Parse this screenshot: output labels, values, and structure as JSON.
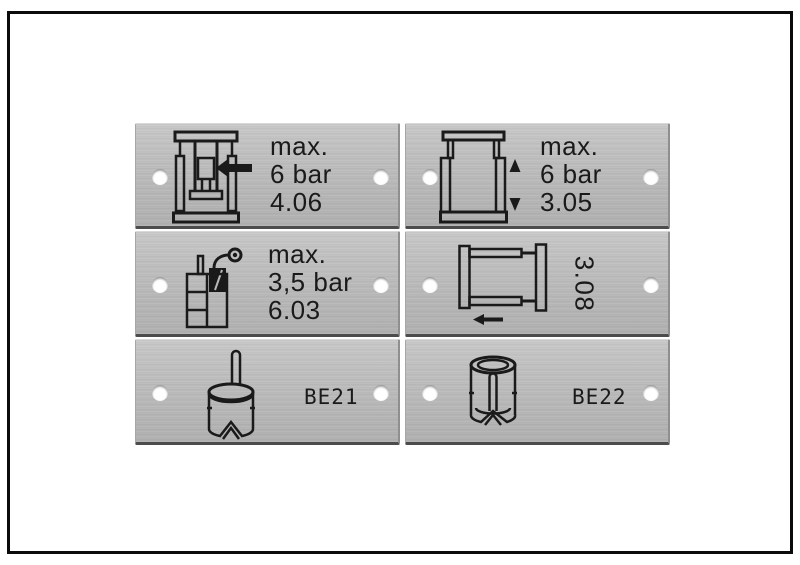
{
  "image": {
    "kind": "product photo of six engraved aluminum machine labels",
    "frame_color": "#0b0b0b",
    "background": "#ffffff",
    "metal_color": "#b8b8b8",
    "ink_color": "#1a1a1a"
  },
  "plates": [
    {
      "name": "toggle-press-label",
      "icon": "toggle-press-icon",
      "lines": [
        "max.",
        "6 bar",
        "4.06"
      ]
    },
    {
      "name": "lift-frame-label",
      "icon": "lift-frame-icon",
      "lines": [
        "max.",
        "6 bar",
        "3.05"
      ]
    },
    {
      "name": "lubricator-label",
      "icon": "lubricator-spray-icon",
      "lines": [
        "max.",
        "3,5 bar",
        "6.03"
      ]
    },
    {
      "name": "slide-frame-label",
      "icon": "slide-frame-arrow-icon",
      "rotated_code": "3.08"
    },
    {
      "name": "be21-label",
      "icon": "cylinder-pin-icon",
      "code": "BE21"
    },
    {
      "name": "be22-label",
      "icon": "cylinder-sleeve-icon",
      "code": "BE22"
    }
  ]
}
